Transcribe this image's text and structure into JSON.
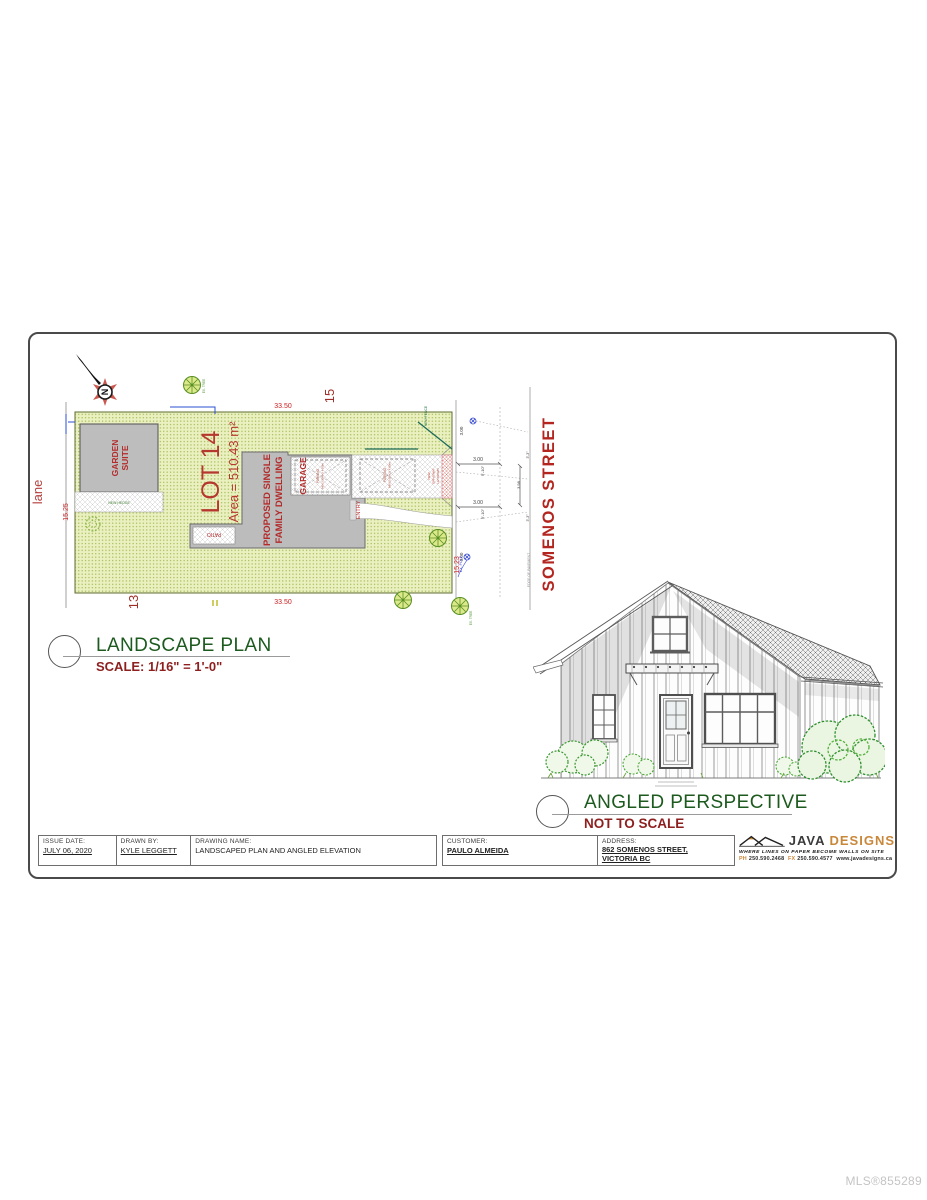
{
  "page": {
    "watermark": "MLS®855289"
  },
  "colors": {
    "brand_orange": "#c9873a",
    "drawing_red": "#b32b2b",
    "title_green": "#1c5a1e",
    "scale_red": "#8e1f1f",
    "lot_fill": "#e9edbe"
  },
  "titles": {
    "plan_title": "LANDSCAPE PLAN",
    "plan_scale": "SCALE: 1/16\" = 1'-0\"",
    "persp_title": "ANGLED PERSPECTIVE",
    "persp_scale": "NOT TO SCALE"
  },
  "plan": {
    "north": "N",
    "lane": "lane",
    "street": "SOMENOS STREET",
    "lot_label": "LOT 14",
    "lot_area": "Area = 510.43 m²",
    "lot_north": "15",
    "lot_south": "13",
    "dim_top": "33.50",
    "dim_bottom": "33.50",
    "dim_west": "15.25",
    "dim_east": "15.23",
    "garden_suite_l1": "GARDEN",
    "garden_suite_l2": "SUITE",
    "dwelling_l1": "PROPOSED SINGLE",
    "dwelling_l2": "FAMILY DWELLING",
    "garage": "GARAGE",
    "patio": "PATIO",
    "entry": "ENTRY",
    "hedge": "NEW HEDGE",
    "fence": "NEW FENCE",
    "parking_l1": "PARKING",
    "parking_l2": "MIN 2.60m X 4.80m",
    "letdown_l1": "NEW",
    "letdown_l2": "DRIVEWAY",
    "letdown_l3": "LETDOWN",
    "edge_of_pavement": "EDGE OF PAVEMENT",
    "pole": "EX. POLE",
    "tree": "EX. TREE",
    "dims": {
      "d1": "3.00",
      "d1b": "9'-10\"",
      "d2": "3.00",
      "d2b": "9'-10\"",
      "dv": "3.98",
      "sb1": "3.00",
      "sb2": "3.00",
      "t1": "3'-3\"",
      "t2": "3'-3\""
    }
  },
  "title_block": {
    "issue_date_label": "ISSUE DATE:",
    "issue_date": "JULY 06, 2020",
    "drawn_by_label": "DRAWN BY:",
    "drawn_by": "KYLE LEGGETT",
    "drawing_name_label": "DRAWING NAME:",
    "drawing_name": "LANDSCAPED PLAN AND ANGLED ELEVATION",
    "customer_label": "CUSTOMER:",
    "customer": "PAULO ALMEIDA",
    "address_label": "ADDRESS:",
    "address_line1": "862 SOMENOS STREET,",
    "address_line2": "VICTORIA BC"
  },
  "logo": {
    "name_java": "JAVA",
    "name_designs": "DESIGNS",
    "tagline": "WHERE LINES ON PAPER BECOME WALLS ON SITE",
    "phone_label": "PH",
    "phone": "250.590.2468",
    "fax_label": "FX",
    "fax": "250.590.4577",
    "website": "www.javadesigns.ca"
  }
}
